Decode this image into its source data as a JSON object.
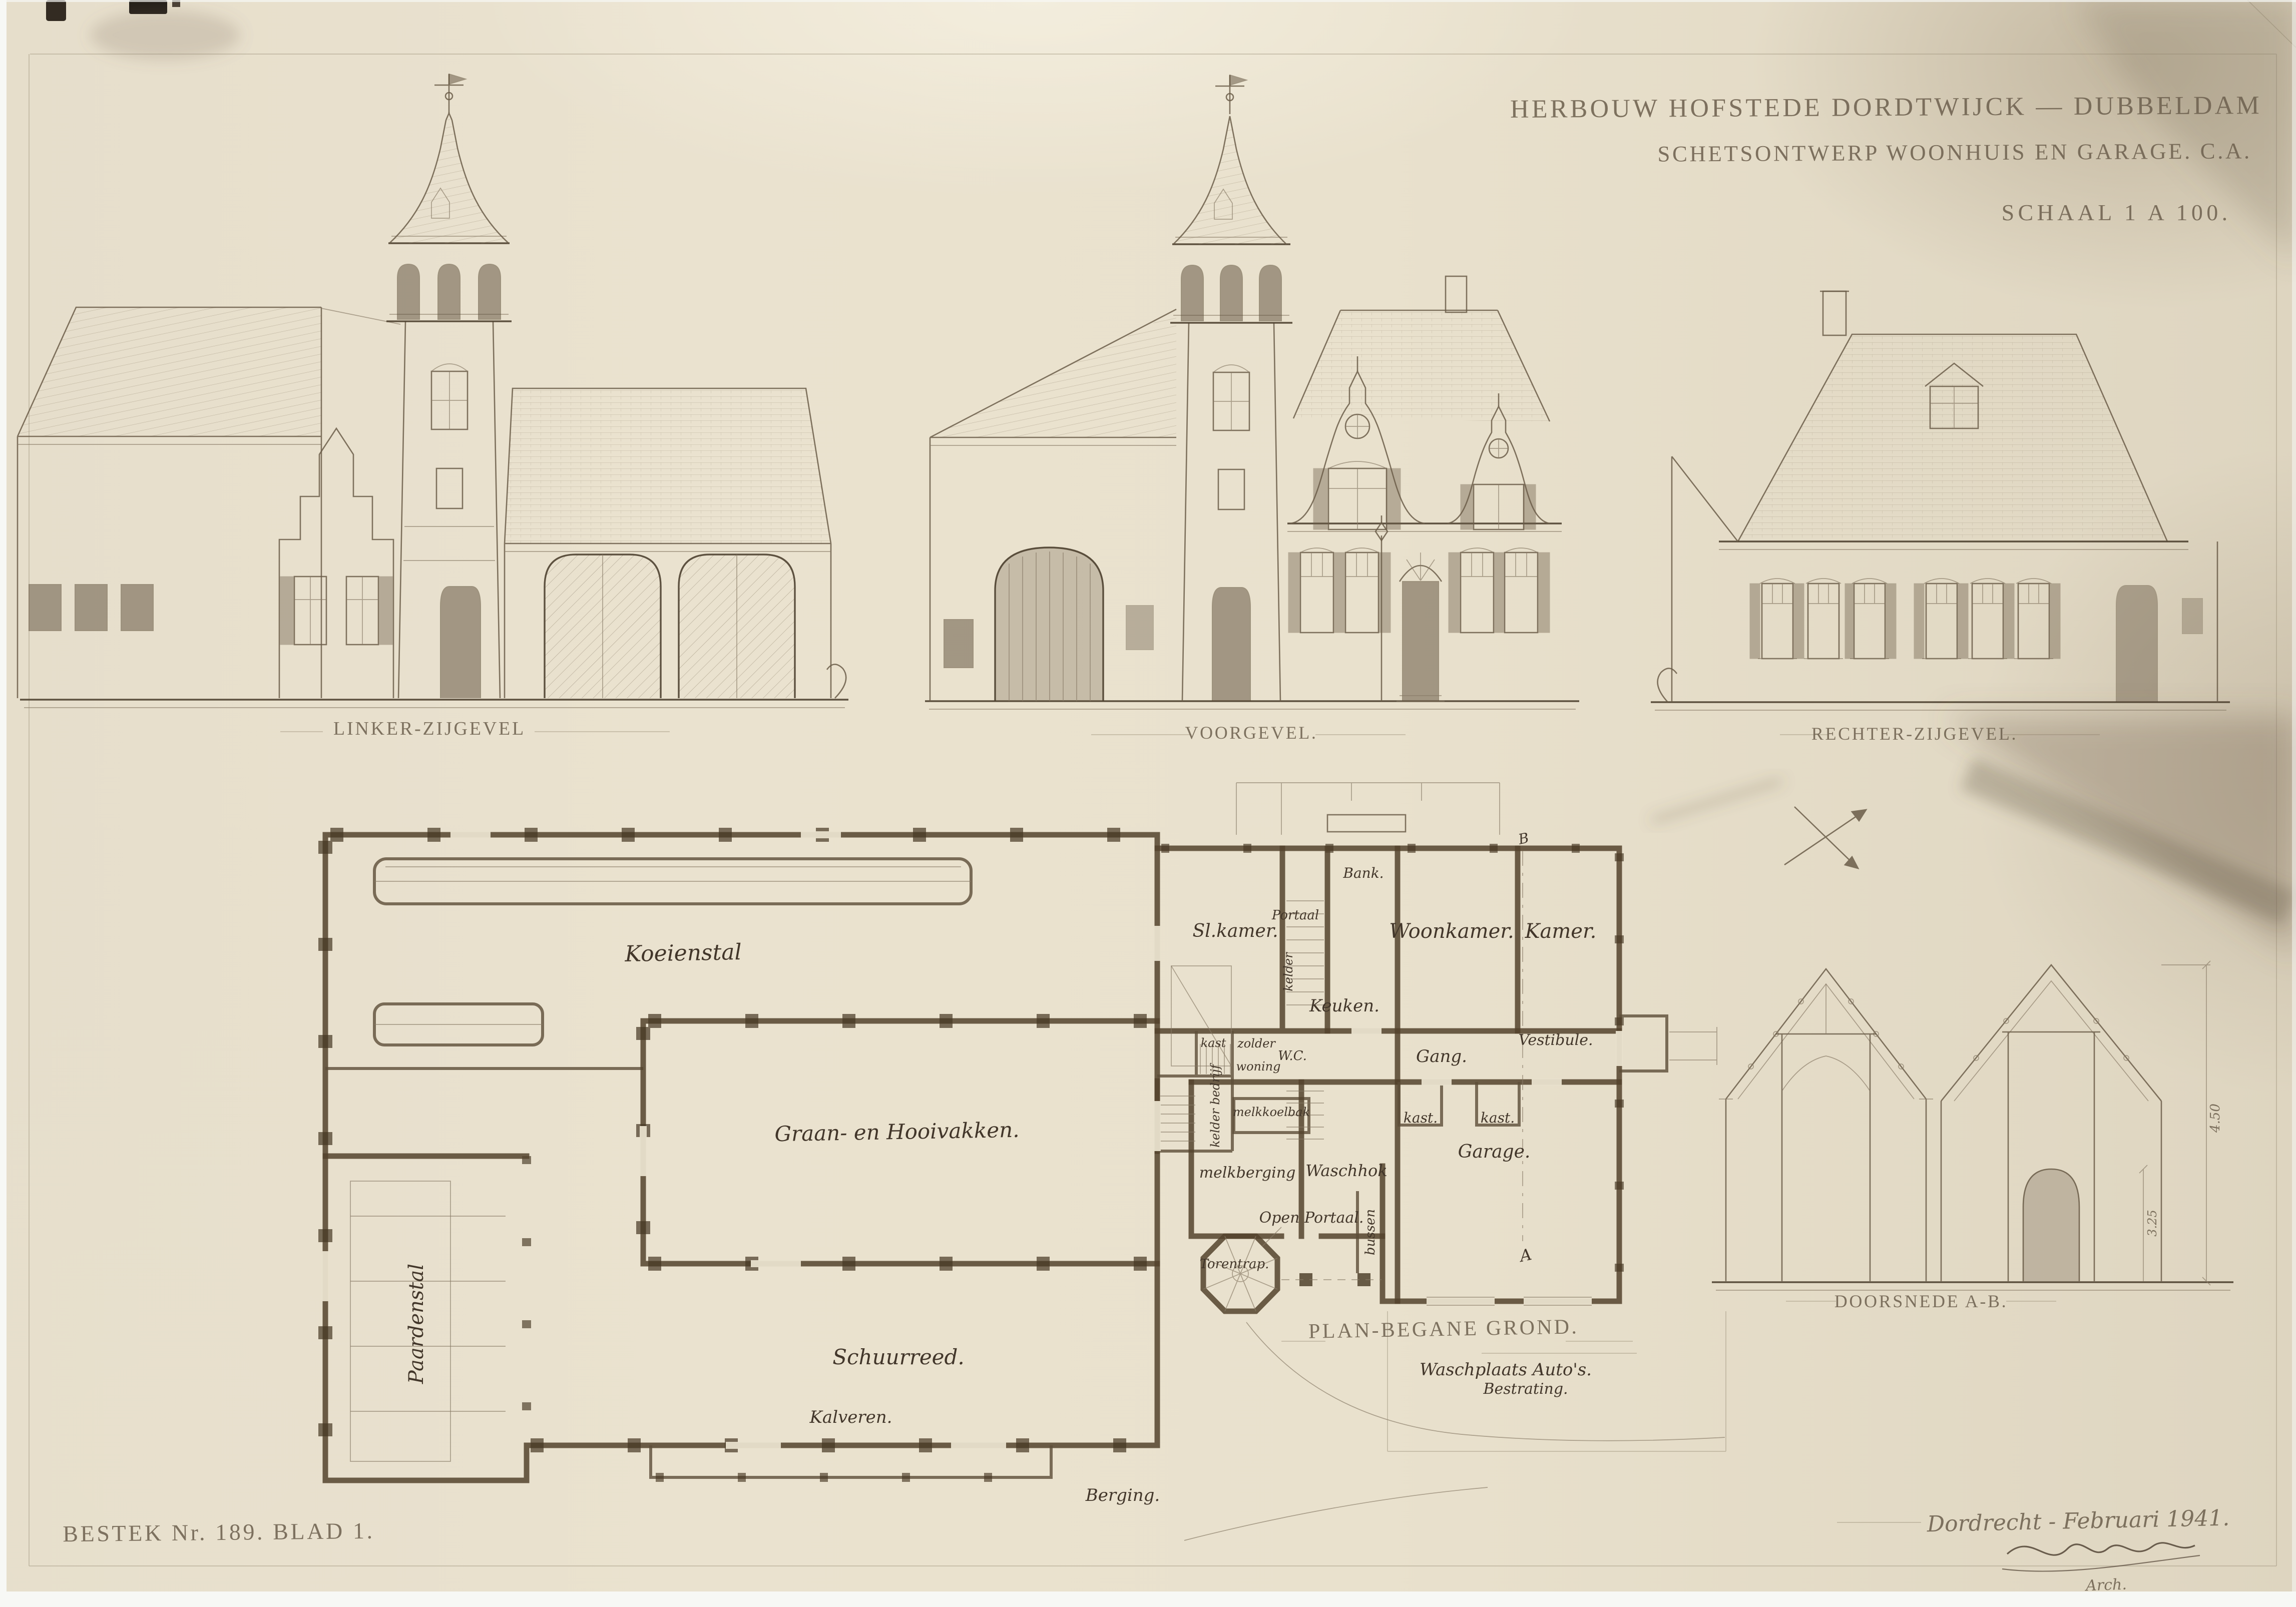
{
  "colors": {
    "paper": "#e8e0cb",
    "ink": "#42362a",
    "pencil": "#6f6250",
    "plan_wall": "#53432d"
  },
  "title_block": {
    "line1": "HERBOUW HOFSTEDE DORDTWIJCK — DUBBELDAM",
    "line2": "SCHETSONTWERP WOONHUIS EN GARAGE. C.A.",
    "line3": "SCHAAL 1 A 100."
  },
  "elevation_labels": {
    "left": "LINKER-ZIJGEVEL",
    "front": "VOORGEVEL.",
    "right": "RECHTER-ZIJGEVEL."
  },
  "plan": {
    "title": "PLAN-BEGANE GROND.",
    "rooms": {
      "koeienstal": "Koeienstal",
      "graan_hooivakken": "Graan- en Hooivakken.",
      "paardenstal": "Paardenstal",
      "schuurreed": "Schuurreed.",
      "kalveren": "Kalveren.",
      "berging": "Berging.",
      "sl_kamer": "Sl.kamer.",
      "portaal": "Portaal",
      "kelder": "kelder",
      "keuken": "Keuken.",
      "woonkamer": "Woonkamer.",
      "kamer": "Kamer.",
      "wc": "W.C.",
      "kast1": "kast.",
      "kast2": "kast.",
      "kast3": "kast",
      "zolder": "zolder",
      "woning": "woning",
      "kelder_bedrijf": "kelder bedrijf",
      "melkkoelbak": "melkkoelbak",
      "melkberging": "melkberging",
      "waschhok": "Waschhok",
      "gang": "Gang.",
      "vestibule": "Vestibule.",
      "garage": "Garage.",
      "bank": "Bank.",
      "open_portaal": "Open Portaal.",
      "torentrap": "Torentrap.",
      "bussen": "bussen",
      "waschplaats": "Waschplaats Auto's.",
      "bestrating": "Bestrating."
    },
    "markers": {
      "a": "A",
      "b": "B"
    }
  },
  "section": {
    "title": "DOORSNEDE A-B.",
    "dims": {
      "h1": "4.50",
      "h2": "3.25"
    }
  },
  "footer": {
    "bestek": "BESTEK Nr. 189. BLAD 1.",
    "date_place": "Dordrecht - Februari 1941.",
    "arch": "Arch."
  }
}
